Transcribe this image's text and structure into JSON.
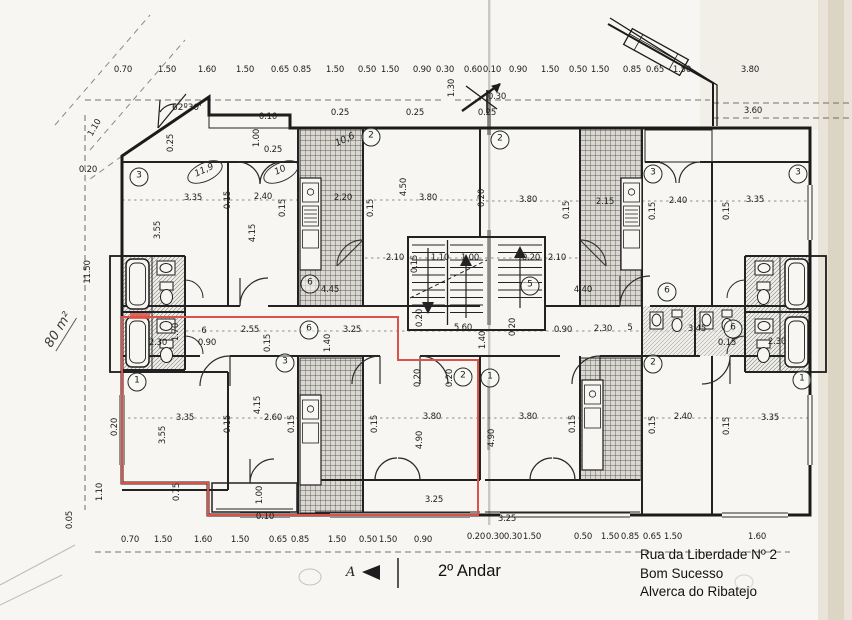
{
  "title": {
    "floor_label": "2º Andar"
  },
  "address": {
    "line1": "Rua da Liberdade Nº 2",
    "line2": "Bom Sucesso",
    "line3": "Alverca do Ribatejo"
  },
  "annotations": {
    "area_note": "80 m²",
    "angle_note": "62º30'",
    "section_marker": "A"
  },
  "colors": {
    "highlight_red": "#d9534a",
    "ink": "#1d1d1d",
    "paper": "#f7f6f2"
  },
  "dim_labels": [
    {
      "t": "0.70",
      "x": 123,
      "y": 70
    },
    {
      "t": "1.50",
      "x": 167,
      "y": 70
    },
    {
      "t": "1.60",
      "x": 207,
      "y": 70
    },
    {
      "t": "1.50",
      "x": 245,
      "y": 70
    },
    {
      "t": "0.65",
      "x": 280,
      "y": 70
    },
    {
      "t": "0.85",
      "x": 302,
      "y": 70
    },
    {
      "t": "1.50",
      "x": 335,
      "y": 70
    },
    {
      "t": "0.50",
      "x": 367,
      "y": 70
    },
    {
      "t": "1.50",
      "x": 390,
      "y": 70
    },
    {
      "t": "0.90",
      "x": 422,
      "y": 70
    },
    {
      "t": "0.30",
      "x": 445,
      "y": 70
    },
    {
      "t": "0.60",
      "x": 473,
      "y": 70
    },
    {
      "t": "0.10",
      "x": 492,
      "y": 70
    },
    {
      "t": "0.90",
      "x": 518,
      "y": 70
    },
    {
      "t": "1.50",
      "x": 550,
      "y": 70
    },
    {
      "t": "0.50",
      "x": 578,
      "y": 70
    },
    {
      "t": "1.50",
      "x": 600,
      "y": 70
    },
    {
      "t": "0.85",
      "x": 632,
      "y": 70
    },
    {
      "t": "0.65",
      "x": 655,
      "y": 70
    },
    {
      "t": "1.50",
      "x": 682,
      "y": 70
    },
    {
      "t": "3.80",
      "x": 750,
      "y": 70
    },
    {
      "t": "3.60",
      "x": 753,
      "y": 111
    },
    {
      "t": "0.30",
      "x": 497,
      "y": 97
    },
    {
      "t": "1.30",
      "x": 452,
      "y": 88,
      "r": -90
    },
    {
      "t": "1.10",
      "x": 95,
      "y": 128,
      "r": -60
    },
    {
      "t": "0.20",
      "x": 88,
      "y": 170
    },
    {
      "t": "11.50",
      "x": 88,
      "y": 272,
      "r": -90
    },
    {
      "t": "0.05",
      "x": 70,
      "y": 520,
      "r": -90
    },
    {
      "t": "1.10",
      "x": 100,
      "y": 492,
      "r": -90
    },
    {
      "t": "0.70",
      "x": 130,
      "y": 540
    },
    {
      "t": "1.50",
      "x": 163,
      "y": 540
    },
    {
      "t": "1.60",
      "x": 203,
      "y": 540
    },
    {
      "t": "1.50",
      "x": 240,
      "y": 540
    },
    {
      "t": "0.65",
      "x": 278,
      "y": 540
    },
    {
      "t": "0.85",
      "x": 300,
      "y": 540
    },
    {
      "t": "1.50",
      "x": 337,
      "y": 540
    },
    {
      "t": "0.50",
      "x": 368,
      "y": 540
    },
    {
      "t": "1.50",
      "x": 388,
      "y": 540
    },
    {
      "t": "0.90",
      "x": 423,
      "y": 540
    },
    {
      "t": "0.20",
      "x": 476,
      "y": 537
    },
    {
      "t": "0.30",
      "x": 495,
      "y": 537
    },
    {
      "t": "0.30",
      "x": 513,
      "y": 537
    },
    {
      "t": "1.50",
      "x": 532,
      "y": 537
    },
    {
      "t": "0.50",
      "x": 583,
      "y": 537
    },
    {
      "t": "1.50",
      "x": 610,
      "y": 537
    },
    {
      "t": "0.85",
      "x": 630,
      "y": 537
    },
    {
      "t": "0.65",
      "x": 652,
      "y": 537
    },
    {
      "t": "1.50",
      "x": 673,
      "y": 537
    },
    {
      "t": "1.60",
      "x": 757,
      "y": 537
    },
    {
      "t": "6",
      "x": 204,
      "y": 331
    },
    {
      "t": "2.55",
      "x": 250,
      "y": 330
    },
    {
      "t": "3.25",
      "x": 352,
      "y": 330
    },
    {
      "t": "5 60",
      "x": 463,
      "y": 328
    },
    {
      "t": "0.90",
      "x": 563,
      "y": 330
    },
    {
      "t": "2.30",
      "x": 603,
      "y": 329
    },
    {
      "t": "5",
      "x": 630,
      "y": 328
    },
    {
      "t": "3.45",
      "x": 697,
      "y": 329
    },
    {
      "t": "2.30",
      "x": 158,
      "y": 343
    },
    {
      "t": "0.90",
      "x": 207,
      "y": 343
    },
    {
      "t": "1.70",
      "x": 176,
      "y": 332,
      "r": -90
    },
    {
      "t": "0.15",
      "x": 268,
      "y": 343,
      "r": -90
    },
    {
      "t": "0.15",
      "x": 727,
      "y": 343
    },
    {
      "t": "2.30",
      "x": 777,
      "y": 342
    },
    {
      "t": "0.20",
      "x": 420,
      "y": 318,
      "r": -90
    },
    {
      "t": "1.40",
      "x": 483,
      "y": 340,
      "r": -90
    },
    {
      "t": "1.40",
      "x": 328,
      "y": 343,
      "r": -90
    },
    {
      "t": "0.20",
      "x": 513,
      "y": 327,
      "r": -90
    },
    {
      "t": "2.10",
      "x": 395,
      "y": 258
    },
    {
      "t": "0.15",
      "x": 415,
      "y": 264,
      "r": -90
    },
    {
      "t": "1.10",
      "x": 440,
      "y": 258
    },
    {
      "t": "1.00",
      "x": 470,
      "y": 258
    },
    {
      "t": "0.20",
      "x": 531,
      "y": 258
    },
    {
      "t": "2.10",
      "x": 557,
      "y": 258
    },
    {
      "t": "3.35",
      "x": 193,
      "y": 198
    },
    {
      "t": "0.15",
      "x": 228,
      "y": 200,
      "r": -90
    },
    {
      "t": "2.40",
      "x": 263,
      "y": 197
    },
    {
      "t": "0.15",
      "x": 283,
      "y": 208,
      "r": -90
    },
    {
      "t": "3.55",
      "x": 158,
      "y": 230,
      "r": -90
    },
    {
      "t": "4.15",
      "x": 253,
      "y": 233,
      "r": -90
    },
    {
      "t": "2.20",
      "x": 343,
      "y": 198
    },
    {
      "t": "0.15",
      "x": 371,
      "y": 208,
      "r": -90
    },
    {
      "t": "3.80",
      "x": 428,
      "y": 198
    },
    {
      "t": "4.50",
      "x": 404,
      "y": 187,
      "r": -90
    },
    {
      "t": "0.20",
      "x": 482,
      "y": 198,
      "r": -90
    },
    {
      "t": "3.80",
      "x": 528,
      "y": 200
    },
    {
      "t": "0.15",
      "x": 567,
      "y": 210,
      "r": -90
    },
    {
      "t": "2.15",
      "x": 605,
      "y": 202
    },
    {
      "t": "0.15",
      "x": 653,
      "y": 211,
      "r": -90
    },
    {
      "t": "2.40",
      "x": 678,
      "y": 201
    },
    {
      "t": "0.15",
      "x": 727,
      "y": 211,
      "r": -90
    },
    {
      "t": "3.35",
      "x": 755,
      "y": 200
    },
    {
      "t": "4.45",
      "x": 330,
      "y": 290
    },
    {
      "t": "4.40",
      "x": 583,
      "y": 290
    },
    {
      "t": "0.10",
      "x": 268,
      "y": 117
    },
    {
      "t": "1.00",
      "x": 257,
      "y": 138,
      "r": -90
    },
    {
      "t": "0.25",
      "x": 273,
      "y": 150
    },
    {
      "t": "0.25",
      "x": 171,
      "y": 143,
      "r": -90
    },
    {
      "t": "0.25",
      "x": 340,
      "y": 113
    },
    {
      "t": "0.25",
      "x": 415,
      "y": 113
    },
    {
      "t": "0.25",
      "x": 487,
      "y": 113
    },
    {
      "t": "3.35",
      "x": 185,
      "y": 418
    },
    {
      "t": "0.15",
      "x": 228,
      "y": 424,
      "r": -90
    },
    {
      "t": "2.60",
      "x": 273,
      "y": 418
    },
    {
      "t": "0.15",
      "x": 292,
      "y": 424,
      "r": -90
    },
    {
      "t": "3.55",
      "x": 163,
      "y": 435,
      "r": -90
    },
    {
      "t": "4.15",
      "x": 258,
      "y": 405,
      "r": -90
    },
    {
      "t": "0.15",
      "x": 375,
      "y": 424,
      "r": -90
    },
    {
      "t": "3.80",
      "x": 432,
      "y": 417
    },
    {
      "t": "3.80",
      "x": 528,
      "y": 417
    },
    {
      "t": "4.90",
      "x": 420,
      "y": 440,
      "r": -90
    },
    {
      "t": "4.90",
      "x": 492,
      "y": 438,
      "r": -90
    },
    {
      "t": "0.20",
      "x": 418,
      "y": 378,
      "r": -90
    },
    {
      "t": "0.20",
      "x": 450,
      "y": 378,
      "r": -90
    },
    {
      "t": "0.15",
      "x": 573,
      "y": 424,
      "r": -90
    },
    {
      "t": "2.40",
      "x": 683,
      "y": 417
    },
    {
      "t": "0.15",
      "x": 653,
      "y": 425,
      "r": -90
    },
    {
      "t": "3.35",
      "x": 770,
      "y": 418
    },
    {
      "t": "0.15",
      "x": 727,
      "y": 426,
      "r": -90
    },
    {
      "t": "1.00",
      "x": 260,
      "y": 495,
      "r": -90
    },
    {
      "t": "0.75",
      "x": 177,
      "y": 492,
      "r": -90
    },
    {
      "t": "3.25",
      "x": 434,
      "y": 500
    },
    {
      "t": "3.25",
      "x": 507,
      "y": 519
    },
    {
      "t": "0.10",
      "x": 265,
      "y": 517
    },
    {
      "t": "0.20",
      "x": 115,
      "y": 427,
      "r": -90
    },
    {
      "t": "10,6",
      "x": 345,
      "y": 140,
      "r": -25,
      "hw": true
    }
  ],
  "room_circles": [
    {
      "n": "3",
      "x": 139,
      "y": 177
    },
    {
      "n": "2",
      "x": 371,
      "y": 137
    },
    {
      "n": "2",
      "x": 500,
      "y": 140
    },
    {
      "n": "3",
      "x": 653,
      "y": 174
    },
    {
      "n": "3",
      "x": 798,
      "y": 174
    },
    {
      "n": "6",
      "x": 310,
      "y": 284
    },
    {
      "n": "5",
      "x": 530,
      "y": 286
    },
    {
      "n": "6",
      "x": 309,
      "y": 330
    },
    {
      "n": "6",
      "x": 733,
      "y": 329
    },
    {
      "n": "6",
      "x": 667,
      "y": 292
    },
    {
      "n": "3",
      "x": 285,
      "y": 363
    },
    {
      "n": "1",
      "x": 137,
      "y": 382
    },
    {
      "n": "2",
      "x": 463,
      "y": 377
    },
    {
      "n": "1",
      "x": 490,
      "y": 378
    },
    {
      "n": "2",
      "x": 653,
      "y": 364
    },
    {
      "n": "1",
      "x": 802,
      "y": 380
    }
  ],
  "handwritten_ovals": [
    {
      "t": "11,9",
      "x": 205,
      "y": 172
    },
    {
      "t": "10",
      "x": 281,
      "y": 172
    }
  ]
}
